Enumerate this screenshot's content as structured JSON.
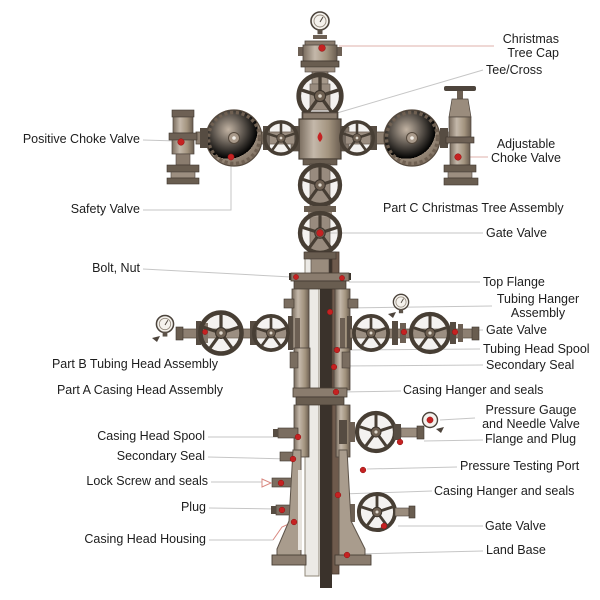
{
  "page": {
    "title": "Christmas Tree (Wellhead) Assembly Diagram",
    "background": "#ffffff"
  },
  "colors": {
    "marker_red": "#c52222",
    "leader_grey": "#c6c6c6",
    "leader_pink": "#dfb0ab",
    "metal_light": "#c8bcae",
    "metal_mid": "#9a8b7b",
    "metal_dark": "#564c42",
    "pipe_dark": "#3a322b",
    "pipe_brown": "#6e5a4c",
    "text": "#1d1d1d"
  },
  "icons": [
    {
      "name": "pressure-gauge-icon",
      "meaning": "round pressure gauge dial"
    },
    {
      "name": "handwheel-icon",
      "meaning": "spoked valve handwheel"
    },
    {
      "name": "disc-valve-icon",
      "meaning": "solid disc valve handwheel"
    }
  ],
  "labels": [
    {
      "id": "positive-choke-valve",
      "side": "left",
      "text": "Positive Choke Valve"
    },
    {
      "id": "safety-valve",
      "side": "left",
      "text": "Safety Valve"
    },
    {
      "id": "bolt-nut",
      "side": "left",
      "text": "Bolt, Nut"
    },
    {
      "id": "part-b-tubing-head",
      "side": "left",
      "text": "Part B Tubing Head Assembly"
    },
    {
      "id": "part-a-casing-head",
      "side": "left",
      "text": "Part A Casing Head Assembly"
    },
    {
      "id": "casing-head-spool",
      "side": "left",
      "text": "Casing Head Spool"
    },
    {
      "id": "secondary-seal-left",
      "side": "left",
      "text": "Secondary Seal"
    },
    {
      "id": "lock-screw-seals",
      "side": "left",
      "text": "Lock Screw and seals"
    },
    {
      "id": "plug",
      "side": "left",
      "text": "Plug"
    },
    {
      "id": "casing-head-housing",
      "side": "left",
      "text": "Casing Head Housing"
    },
    {
      "id": "christmas-tree-cap",
      "side": "right",
      "text": "Christmas\nTree Cap"
    },
    {
      "id": "tee-cross",
      "side": "right",
      "text": "Tee/Cross"
    },
    {
      "id": "adjustable-choke-valve",
      "side": "right",
      "text": "Adjustable\nChoke Valve"
    },
    {
      "id": "part-c-christmas-tree",
      "side": "right",
      "text": "Part C Christmas Tree Assembly"
    },
    {
      "id": "gate-valve-upper",
      "side": "right",
      "text": "Gate Valve"
    },
    {
      "id": "top-flange",
      "side": "right",
      "text": "Top Flange"
    },
    {
      "id": "tubing-hanger-assembly",
      "side": "right",
      "text": "Tubing Hanger\nAssembly"
    },
    {
      "id": "gate-valve-middle",
      "side": "right",
      "text": "Gate Valve"
    },
    {
      "id": "tubing-head-spool",
      "side": "right",
      "text": "Tubing Head Spool"
    },
    {
      "id": "secondary-seal-right",
      "side": "right",
      "text": "Secondary Seal"
    },
    {
      "id": "casing-hanger-upper",
      "side": "right",
      "text": "Casing Hanger and seals"
    },
    {
      "id": "pressure-gauge-needle",
      "side": "right",
      "text": "Pressure Gauge\nand Needle Valve"
    },
    {
      "id": "flange-and-plug",
      "side": "right",
      "text": "Flange and Plug"
    },
    {
      "id": "pressure-testing-port",
      "side": "right",
      "text": "Pressure Testing Port"
    },
    {
      "id": "casing-hanger-lower",
      "side": "right",
      "text": "Casing Hanger and seals"
    },
    {
      "id": "gate-valve-lower",
      "side": "right",
      "text": "Gate Valve"
    },
    {
      "id": "land-base",
      "side": "right",
      "text": "Land Base"
    }
  ]
}
